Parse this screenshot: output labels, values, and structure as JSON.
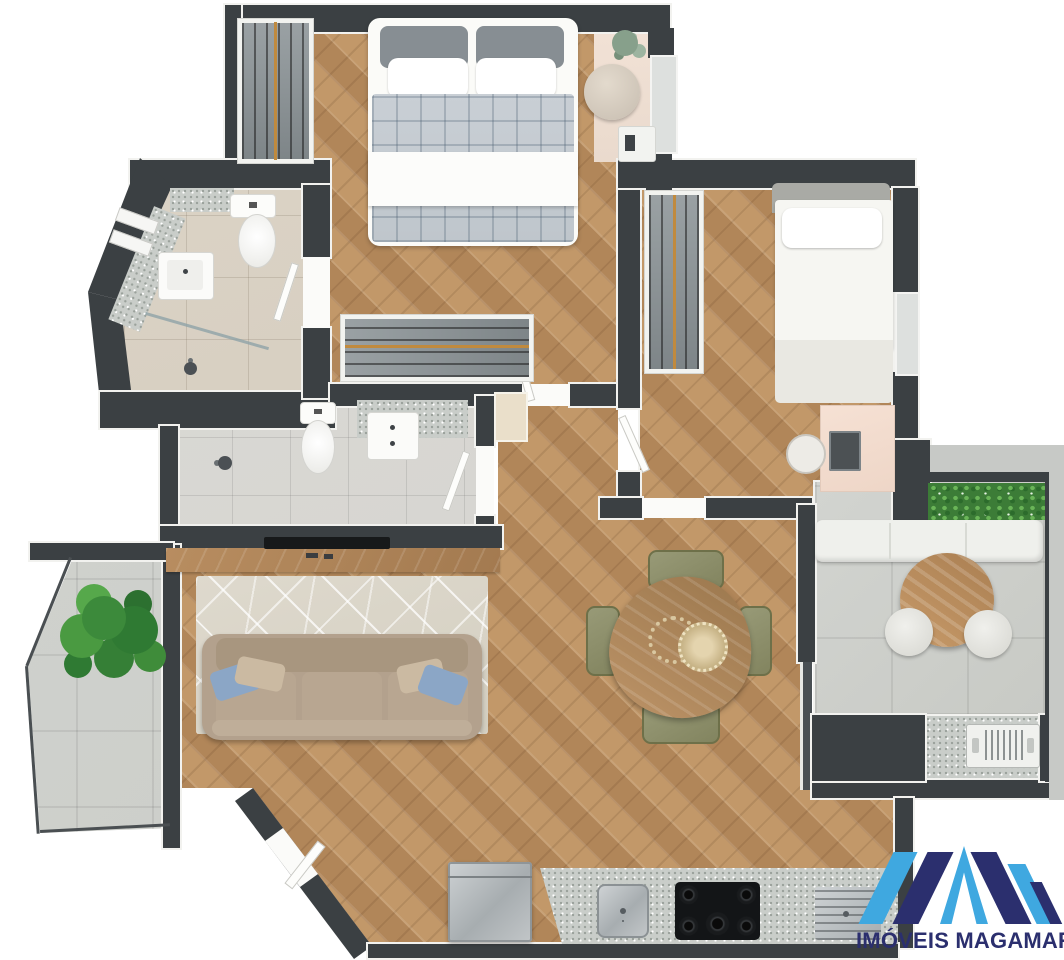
{
  "brand": {
    "logo_text": "IMÓVEIS MAGAMAR",
    "logo_mark": "double-peak-M-monogram",
    "logo_light_blue": "#3FA8E0",
    "logo_navy": "#2B2F6E"
  },
  "palette": {
    "wall": "#3B4043",
    "wall_trim": "#F2F2EF",
    "wood_floor": "#B98E63",
    "bathroom_tile_beige": "#D7CFC3",
    "bathroom_tile_gray": "#D9D8D4",
    "balcony_concrete": "#CDCFCA",
    "bedroom_rug_pink": "#F0DED2",
    "living_rug": "#DBD6CA",
    "sofa_taupe": "#B3A18D",
    "dining_chair_olive": "#8F9271",
    "plant_green": "#3C7C37",
    "counter_speckle": "#C9CDC9",
    "closet_rod_gold": "#C08A3E"
  },
  "plan": {
    "type": "apartment-floor-plan-3d-top-view",
    "rooms": [
      "master-bedroom",
      "bedroom-2",
      "ensuite-bathroom",
      "shower-bathroom",
      "hallway",
      "living-room",
      "dining-area",
      "kitchen",
      "entry",
      "left-balcony",
      "right-terrace",
      "service-niche"
    ],
    "fixtures": [
      "double-bed",
      "single-bed",
      "wardrobe-hangers",
      "toilet",
      "washbasin",
      "shower-head",
      "glass-divider",
      "tv-console",
      "sofa",
      "area-rug",
      "dining-table",
      "dining-chairs",
      "desk",
      "desk-chair",
      "laptop",
      "pouf",
      "potted-plant",
      "planter-hedge",
      "bench-seat",
      "round-table",
      "stools",
      "air-conditioner-unit",
      "fridge",
      "kitchen-sink",
      "gas-cooktop",
      "built-in-oven",
      "entry-door",
      "sliding-door",
      "window"
    ]
  }
}
